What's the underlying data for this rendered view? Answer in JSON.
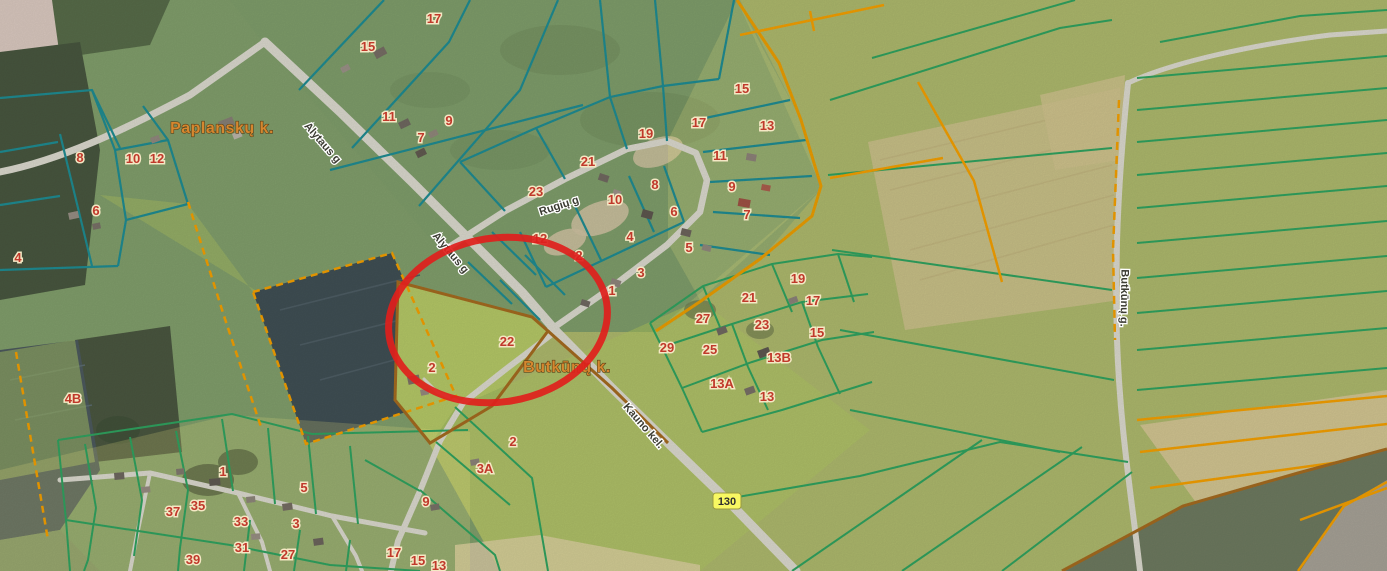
{
  "map": {
    "annotation": {
      "shape": "ellipse",
      "cx": 498,
      "cy": 320,
      "rx": 110,
      "ry": 82,
      "rotate": -9,
      "color": "#e0201c"
    },
    "road_badge": {
      "text": "130",
      "x": 727,
      "y": 501,
      "bg": "#f8f862"
    },
    "place_labels": [
      {
        "text": "Paplanskų k.",
        "x": 222,
        "y": 133
      },
      {
        "text": "Butkūnų k.",
        "x": 567,
        "y": 372
      }
    ],
    "street_labels": [
      {
        "text": "Alytaus g",
        "x": 320,
        "y": 145,
        "rotate": 49
      },
      {
        "text": "Alytaus g",
        "x": 448,
        "y": 255,
        "rotate": 50
      },
      {
        "text": "Rugių g",
        "x": 560,
        "y": 209,
        "rotate": -18
      },
      {
        "text": "Kauno kel.",
        "x": 641,
        "y": 428,
        "rotate": 49
      },
      {
        "text": "Butkūnų g.",
        "x": 1121,
        "y": 298,
        "rotate": 91
      }
    ],
    "parcel_numbers": [
      {
        "text": "8",
        "x": 80,
        "y": 162
      },
      {
        "text": "10",
        "x": 133,
        "y": 163
      },
      {
        "text": "12",
        "x": 157,
        "y": 163
      },
      {
        "text": "6",
        "x": 96,
        "y": 215
      },
      {
        "text": "4",
        "x": 18,
        "y": 262
      },
      {
        "text": "17",
        "x": 434,
        "y": 23
      },
      {
        "text": "15",
        "x": 368,
        "y": 51
      },
      {
        "text": "11",
        "x": 389,
        "y": 121
      },
      {
        "text": "9",
        "x": 449,
        "y": 125
      },
      {
        "text": "7",
        "x": 421,
        "y": 142
      },
      {
        "text": "15",
        "x": 742,
        "y": 93
      },
      {
        "text": "17",
        "x": 699,
        "y": 127
      },
      {
        "text": "13",
        "x": 767,
        "y": 130
      },
      {
        "text": "19",
        "x": 646,
        "y": 138
      },
      {
        "text": "11",
        "x": 720,
        "y": 160
      },
      {
        "text": "21",
        "x": 588,
        "y": 166
      },
      {
        "text": "8",
        "x": 655,
        "y": 189
      },
      {
        "text": "23",
        "x": 536,
        "y": 196
      },
      {
        "text": "10",
        "x": 615,
        "y": 204
      },
      {
        "text": "9",
        "x": 732,
        "y": 191
      },
      {
        "text": "6",
        "x": 674,
        "y": 216
      },
      {
        "text": "7",
        "x": 747,
        "y": 219
      },
      {
        "text": "12",
        "x": 540,
        "y": 243
      },
      {
        "text": "4",
        "x": 630,
        "y": 241
      },
      {
        "text": "2",
        "x": 579,
        "y": 260
      },
      {
        "text": "5",
        "x": 689,
        "y": 252
      },
      {
        "text": "3",
        "x": 641,
        "y": 277
      },
      {
        "text": "1",
        "x": 612,
        "y": 295
      },
      {
        "text": "22",
        "x": 507,
        "y": 346
      },
      {
        "text": "2",
        "x": 432,
        "y": 372
      },
      {
        "text": "4B",
        "x": 73,
        "y": 403
      },
      {
        "text": "19",
        "x": 798,
        "y": 283
      },
      {
        "text": "21",
        "x": 749,
        "y": 302
      },
      {
        "text": "17",
        "x": 813,
        "y": 305
      },
      {
        "text": "27",
        "x": 703,
        "y": 323
      },
      {
        "text": "23",
        "x": 762,
        "y": 329
      },
      {
        "text": "15",
        "x": 817,
        "y": 337
      },
      {
        "text": "29",
        "x": 667,
        "y": 352
      },
      {
        "text": "25",
        "x": 710,
        "y": 354
      },
      {
        "text": "13B",
        "x": 779,
        "y": 362
      },
      {
        "text": "13A",
        "x": 722,
        "y": 388
      },
      {
        "text": "13",
        "x": 767,
        "y": 401
      },
      {
        "text": "1",
        "x": 223,
        "y": 476
      },
      {
        "text": "5",
        "x": 304,
        "y": 492
      },
      {
        "text": "35",
        "x": 198,
        "y": 510
      },
      {
        "text": "37",
        "x": 173,
        "y": 516
      },
      {
        "text": "33",
        "x": 241,
        "y": 526
      },
      {
        "text": "3",
        "x": 296,
        "y": 528
      },
      {
        "text": "31",
        "x": 242,
        "y": 552
      },
      {
        "text": "27",
        "x": 288,
        "y": 559
      },
      {
        "text": "39",
        "x": 193,
        "y": 564
      },
      {
        "text": "9",
        "x": 426,
        "y": 506
      },
      {
        "text": "2",
        "x": 513,
        "y": 446
      },
      {
        "text": "3A",
        "x": 485,
        "y": 473
      },
      {
        "text": "17",
        "x": 394,
        "y": 557
      },
      {
        "text": "15",
        "x": 418,
        "y": 565
      },
      {
        "text": "13",
        "x": 439,
        "y": 570
      }
    ],
    "colors": {
      "boundary_teal": "#1e8a90",
      "boundary_green": "#2fa05e",
      "boundary_orange": "#f09d00",
      "boundary_brown": "#a2691f",
      "parcel_number_red": "#c0392b",
      "place_label_orange": "#d5872f",
      "road_fill": "#d8d6cb",
      "annotation_red": "#e0201c",
      "badge_yellow": "#f8f862"
    }
  }
}
